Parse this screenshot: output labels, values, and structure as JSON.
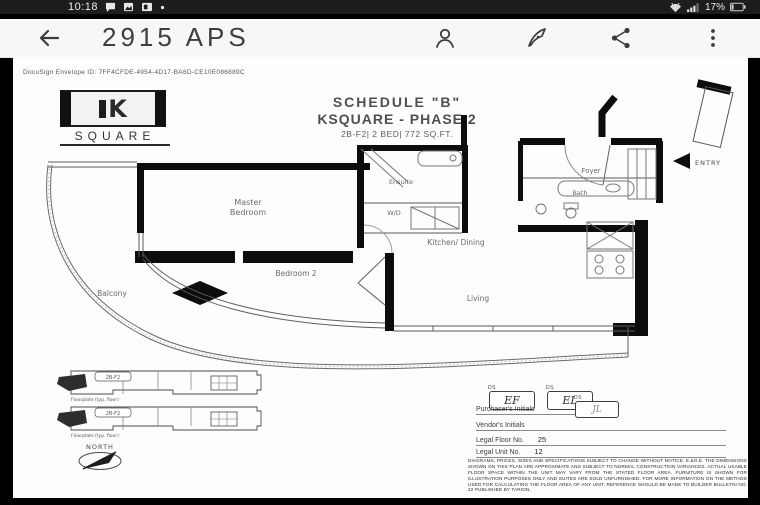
{
  "status_bar": {
    "time": "10:18",
    "battery_pct": "17%"
  },
  "app_bar": {
    "title": "2915 APS"
  },
  "doc": {
    "envelope_id": "DocuSign Envelope ID: 7FF4CFDE-4954-4D17-BA6D-CE10E086889C",
    "logo": {
      "letter": "K",
      "word": "SQUARE"
    },
    "schedule_title": "SCHEDULE \"B\"",
    "project_title": "KSQUARE - PHASE 2",
    "unit_specs": "2B-F2| 2 BED| 772 SQ.FT.",
    "rooms": {
      "master_line1": "Master",
      "master_line2": "Bedroom",
      "ensuite": "Ensuite",
      "wd": "W/D",
      "foyer": "Foyer",
      "bath": "Bath",
      "kitchen_dining": "Kitchen/ Dining",
      "living": "Living",
      "bedroom2": "Bedroom 2",
      "balcony": "Balcony"
    },
    "entry": "ENTRY",
    "keyplans": [
      {
        "unit_tag": "2B-F2",
        "caption": "Floorplate (typ. floor)"
      },
      {
        "unit_tag": "2B-F2",
        "caption": "Floorplate (typ. floor)"
      }
    ],
    "north": "NORTH",
    "signing": {
      "ds": "DS",
      "purchaser_initials_1": "EF",
      "purchaser_initials_2": "EL",
      "purchaser_label": "Purchaser's Initials",
      "vendor_initials": "JL",
      "vendor_label": "Vendor's Initials",
      "legal_floor_label": "Legal Floor No.",
      "legal_floor_value": "25",
      "legal_unit_label": "Legal Unit No.",
      "legal_unit_value": "12"
    },
    "disclaimer": "DIAGRAMS, PRICES, SIZES AND SPECIFICATIONS SUBJECT TO CHANGE WITHOUT NOTICE. E.&O.E. THE DIMENSIONS SHOWN ON THIS PLAN ARE APPROXIMATE AND SUBJECT TO NORMAL CONSTRUCTION VARIANCES. ACTUAL USABLE FLOOR SPACE WITHIN THE UNIT MAY VARY FROM THE STATED FLOOR AREA. FURNITURE IS SHOWN FOR ILLUSTRATION PURPOSES ONLY AND SUITES ARE SOLD UNFURNISHED. FOR MORE INFORMATION ON THE METHOD USED FOR CALCULATING THE FLOOR AREA OF ANY UNIT, REFERENCE SHOULD BE MADE TO BUILDER BULLETIN NO. 22 PUBLISHED BY TARION."
  },
  "colors": {
    "status_bg": "#1d1d1d",
    "appbar_bg": "#f7f7f7",
    "doc_text": "#555555",
    "wall": "#0d0d0d"
  }
}
